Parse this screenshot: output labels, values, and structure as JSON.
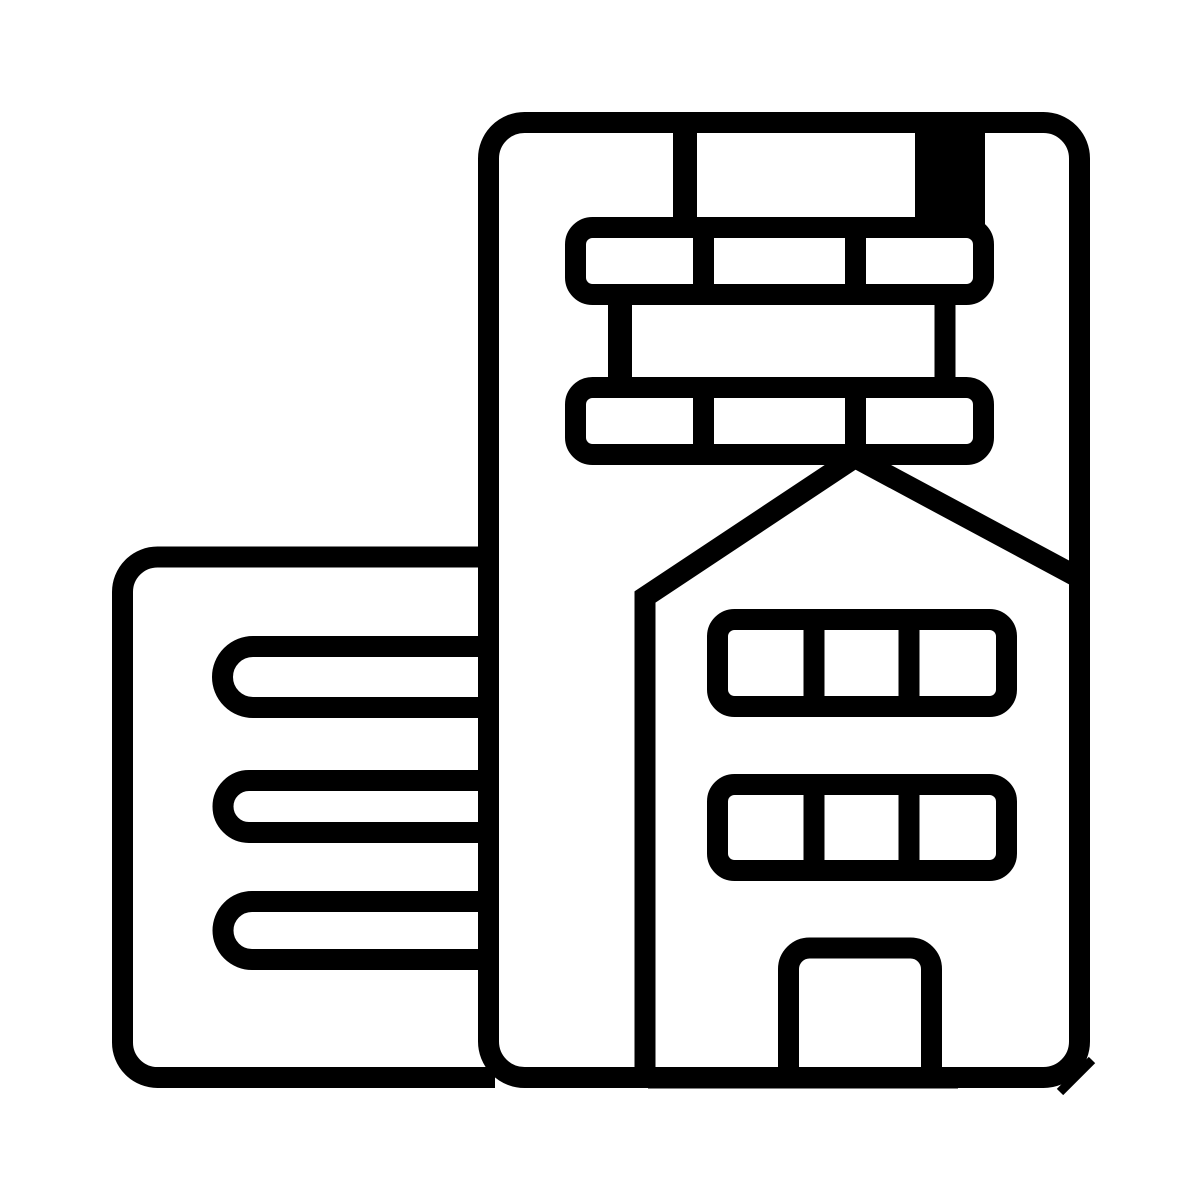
{
  "page": {
    "background_color": "#ffffff"
  },
  "icon": {
    "label": "City buildings icon",
    "color": "#000000",
    "parts": {
      "tall_building": "tall office building outline",
      "window_band_top": "upper band of three windows",
      "window_band_second": "second band of three windows",
      "rooftop_block": "solid block between roof line and upper window band",
      "house": "gable-roof house overlapping the tall building",
      "house_window_rows": "two rows of three windows",
      "door": "arched-top door at bottom center",
      "left_building": "low side building with three horizontal window slots"
    }
  }
}
